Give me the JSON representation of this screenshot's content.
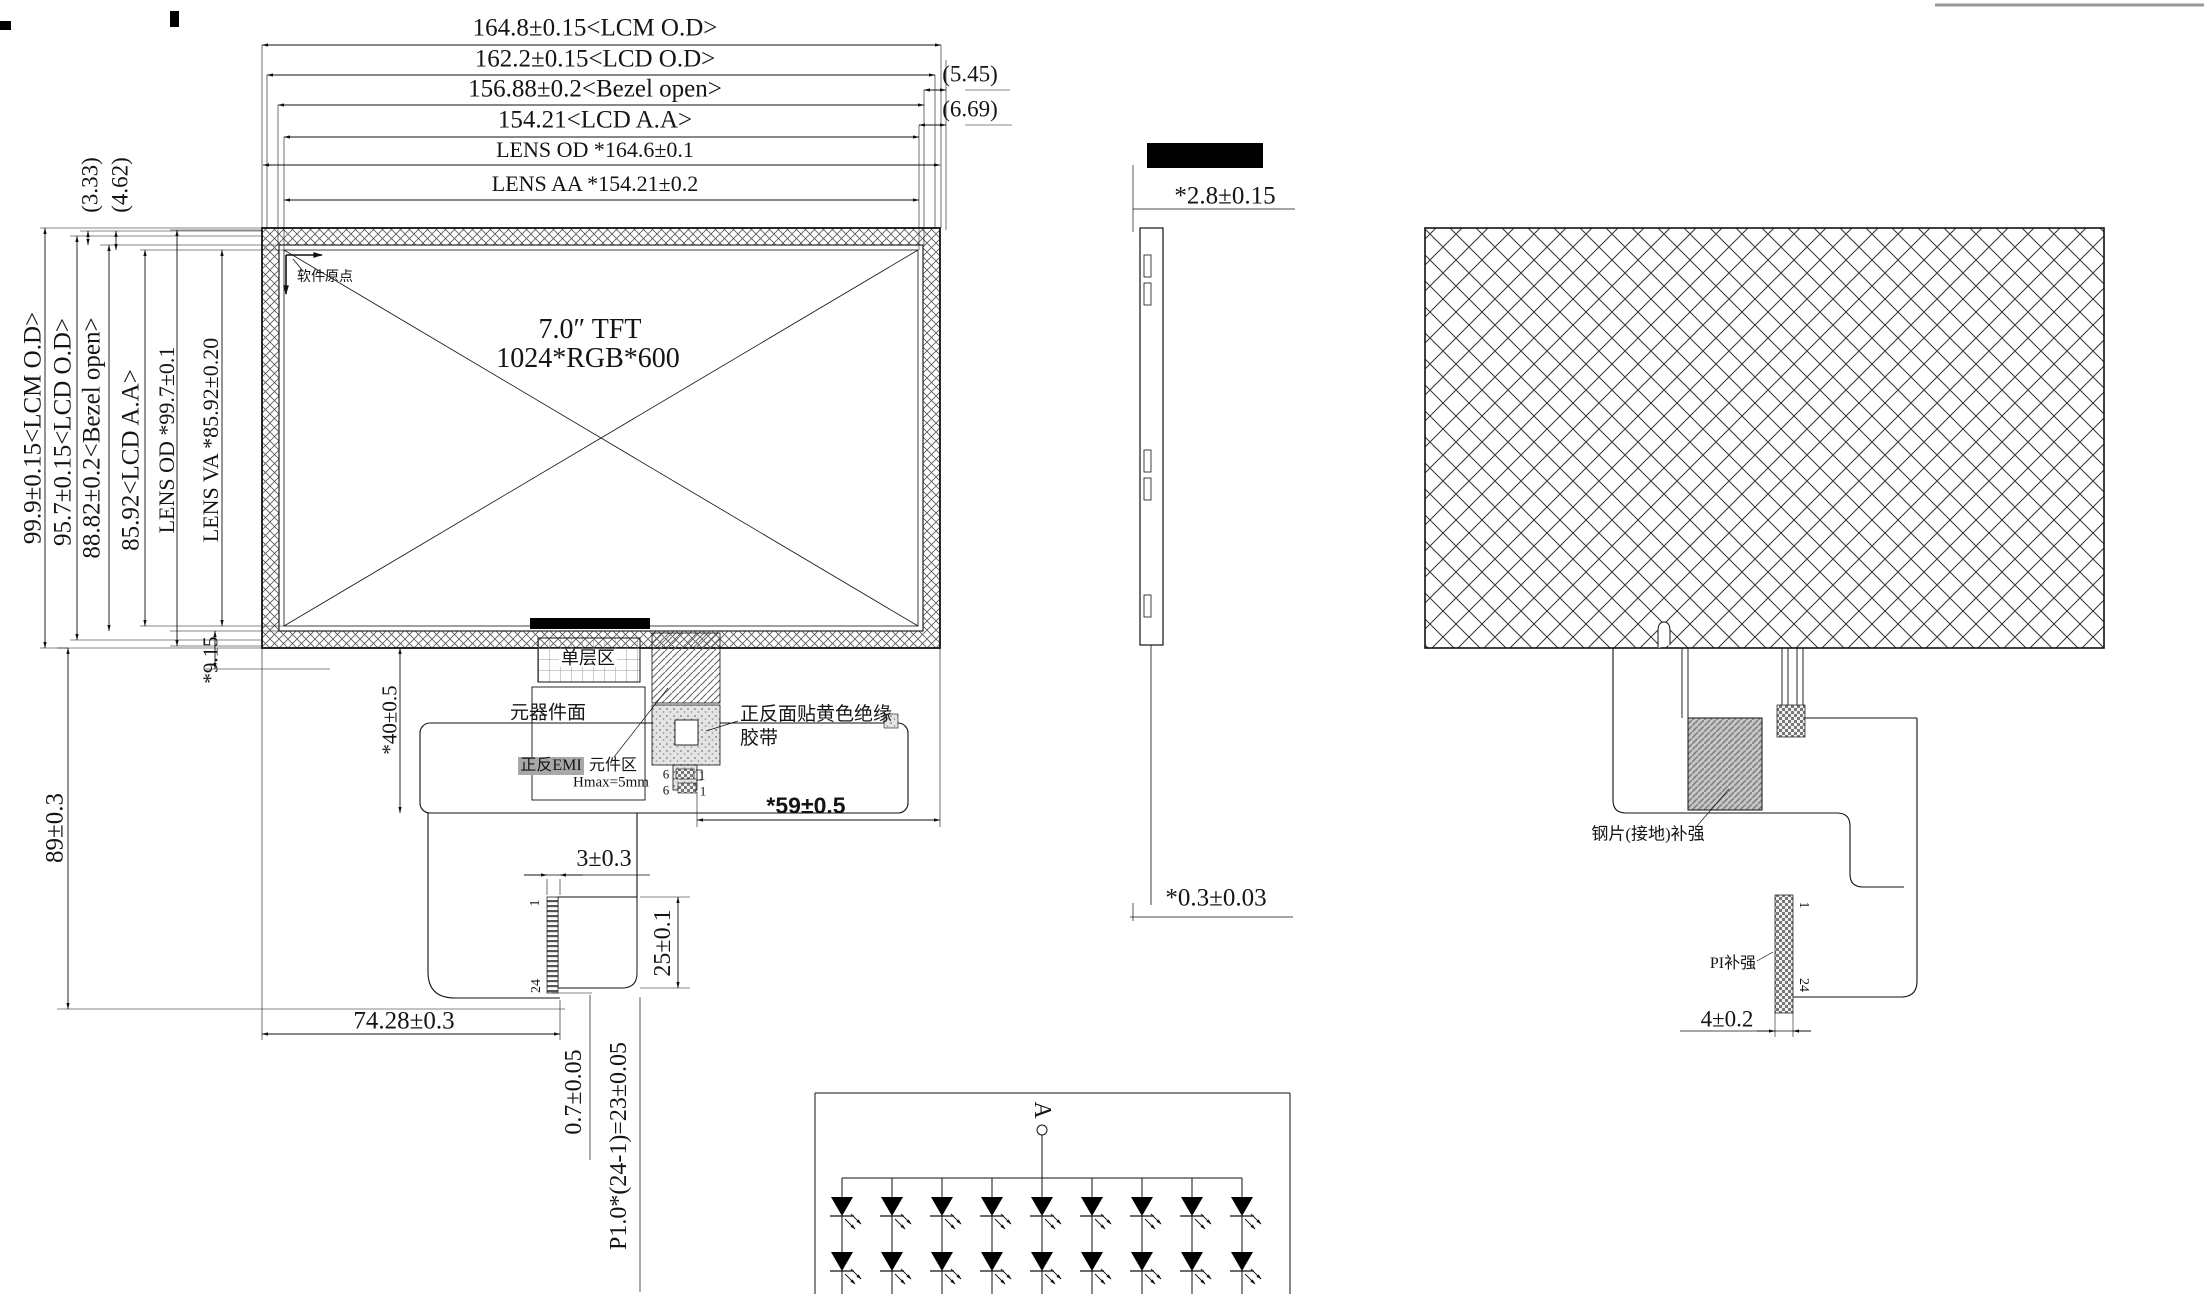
{
  "front": {
    "panel_line1": "7.0″ TFT",
    "panel_line2": "1024*RGB*600",
    "origin_label": "软件原点",
    "dims_top": [
      "164.8±0.15<LCM O.D>",
      "162.2±0.15<LCD O.D>",
      "156.88±0.2<Bezel open>",
      "154.21<LCD A.A>",
      "LENS OD *164.6±0.1",
      "LENS AA *154.21±0.2"
    ],
    "dims_top_right": [
      "(5.45)",
      "(6.69)"
    ],
    "dims_left": [
      "99.9±0.15<LCM O.D>",
      "95.7±0.15<LCD O.D>",
      "88.82±0.2<Bezel open>",
      "85.92<LCD A.A>",
      "LENS OD *99.7±0.1",
      "LENS VA *85.92±0.20"
    ],
    "dims_left_top": [
      "(3.33)",
      "(4.62)"
    ],
    "dim_step": "*9.15",
    "dim_total_height": "89±0.3",
    "dim_comp_height": "*40±0.5",
    "dim_tail_offset": "*59±0.5",
    "label_single_layer": "单层区",
    "label_component_side": "元器件面",
    "label_emi": "正反EMI",
    "label_component_area": "元件区",
    "label_hmax": "Hmax=5mm",
    "label_tape_line1": "正反面贴黄色绝缘",
    "label_tape_line2": "胶带",
    "connector": {
      "rows": [
        {
          "left": "6",
          "right": "1"
        },
        {
          "left": "6",
          "right": "1"
        }
      ]
    },
    "fpc": {
      "dim_width": "3±0.3",
      "dim_contact_len": "25±0.1",
      "dim_offset": "74.28±0.3",
      "dim_pitch": "0.7±0.05",
      "dim_total_pitch": "P1.0*(24-1)=23±0.05",
      "pin_first": "1",
      "pin_last": "24"
    }
  },
  "side": {
    "dim_thickness": "*2.8±0.15",
    "dim_fpc_thickness": "*0.3±0.03"
  },
  "back": {
    "label_steel": "钢片(接地)补强",
    "label_pi": "PI补强",
    "dim_tail_width": "4±0.2",
    "pin_first": "1",
    "pin_last": "24"
  },
  "circuit": {
    "anode_label": "A",
    "columns": 9,
    "rows": 2
  }
}
